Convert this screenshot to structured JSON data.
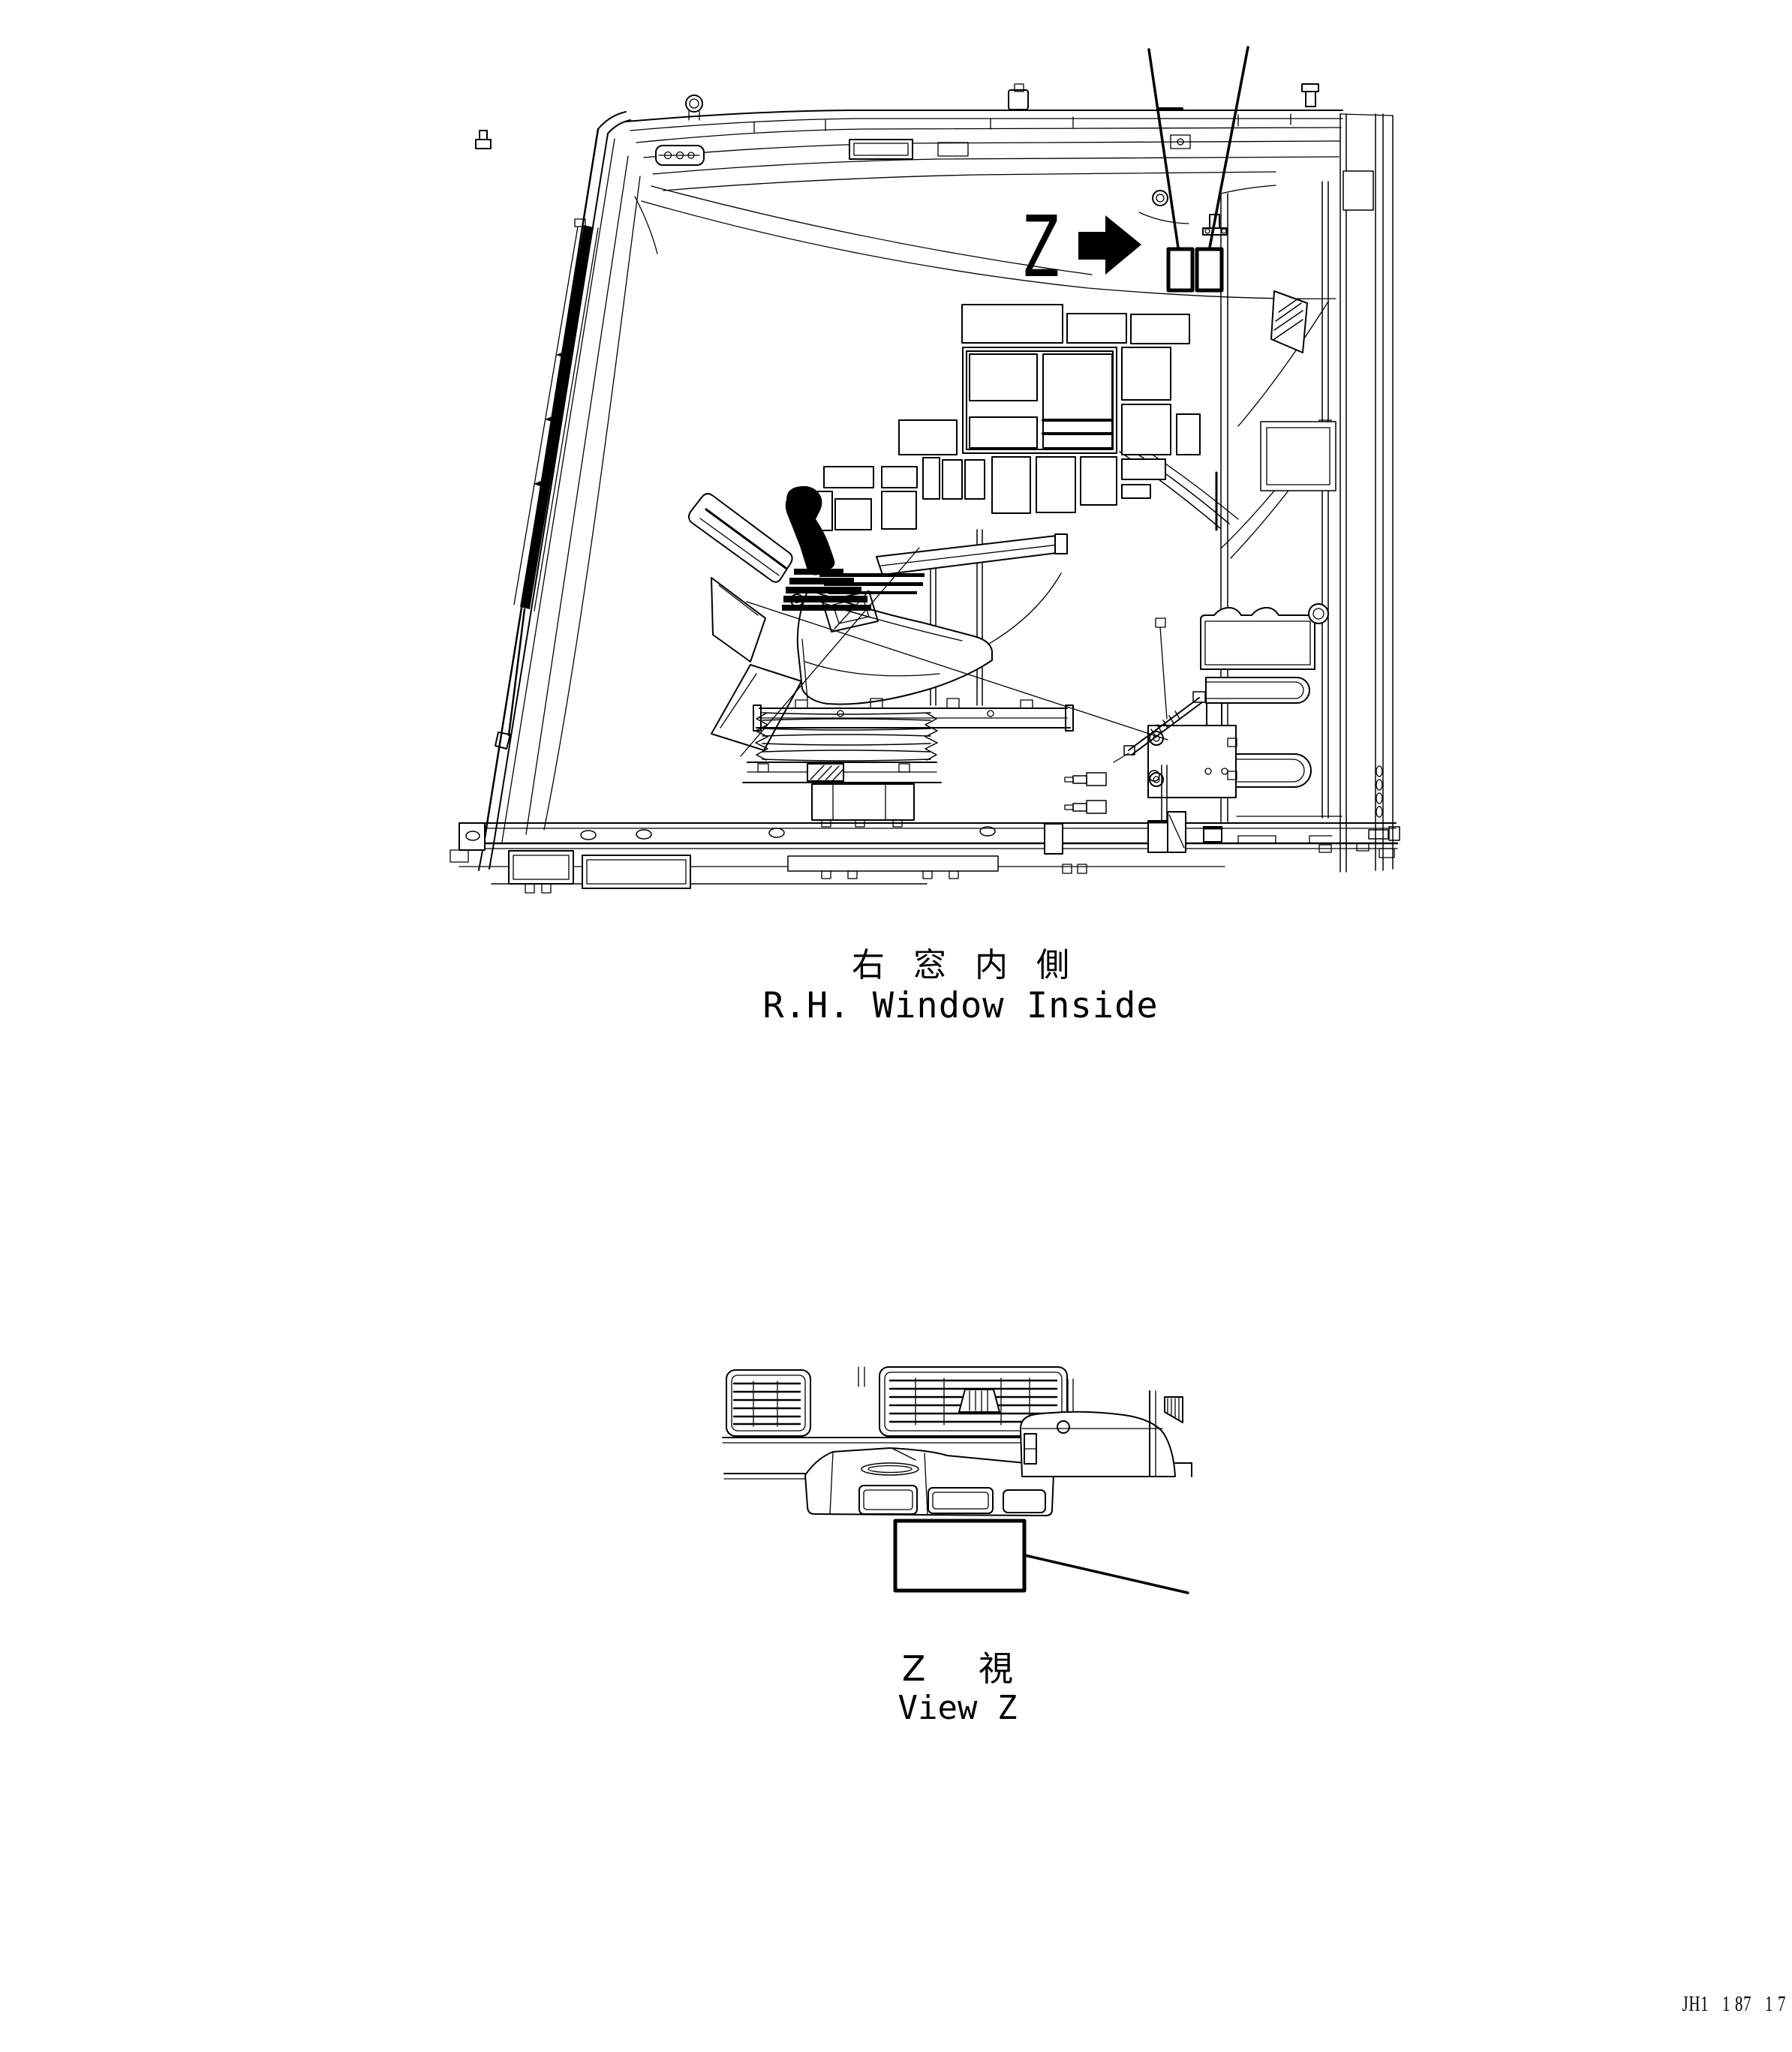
{
  "document": {
    "kind": "technical parts drawing",
    "background_color": "#ffffff",
    "ink_color": "#000000"
  },
  "main_view": {
    "caption_jp": "右 窓 内 側",
    "caption_en": "R.H. Window Inside",
    "marker": {
      "letter": "Z",
      "icon": "solid-right-arrow",
      "decal_count": 2
    }
  },
  "detail_view": {
    "caption_jp": "Z 視",
    "caption_en": "View Z"
  },
  "footer": {
    "code": "JH1   1 87   1 7"
  }
}
